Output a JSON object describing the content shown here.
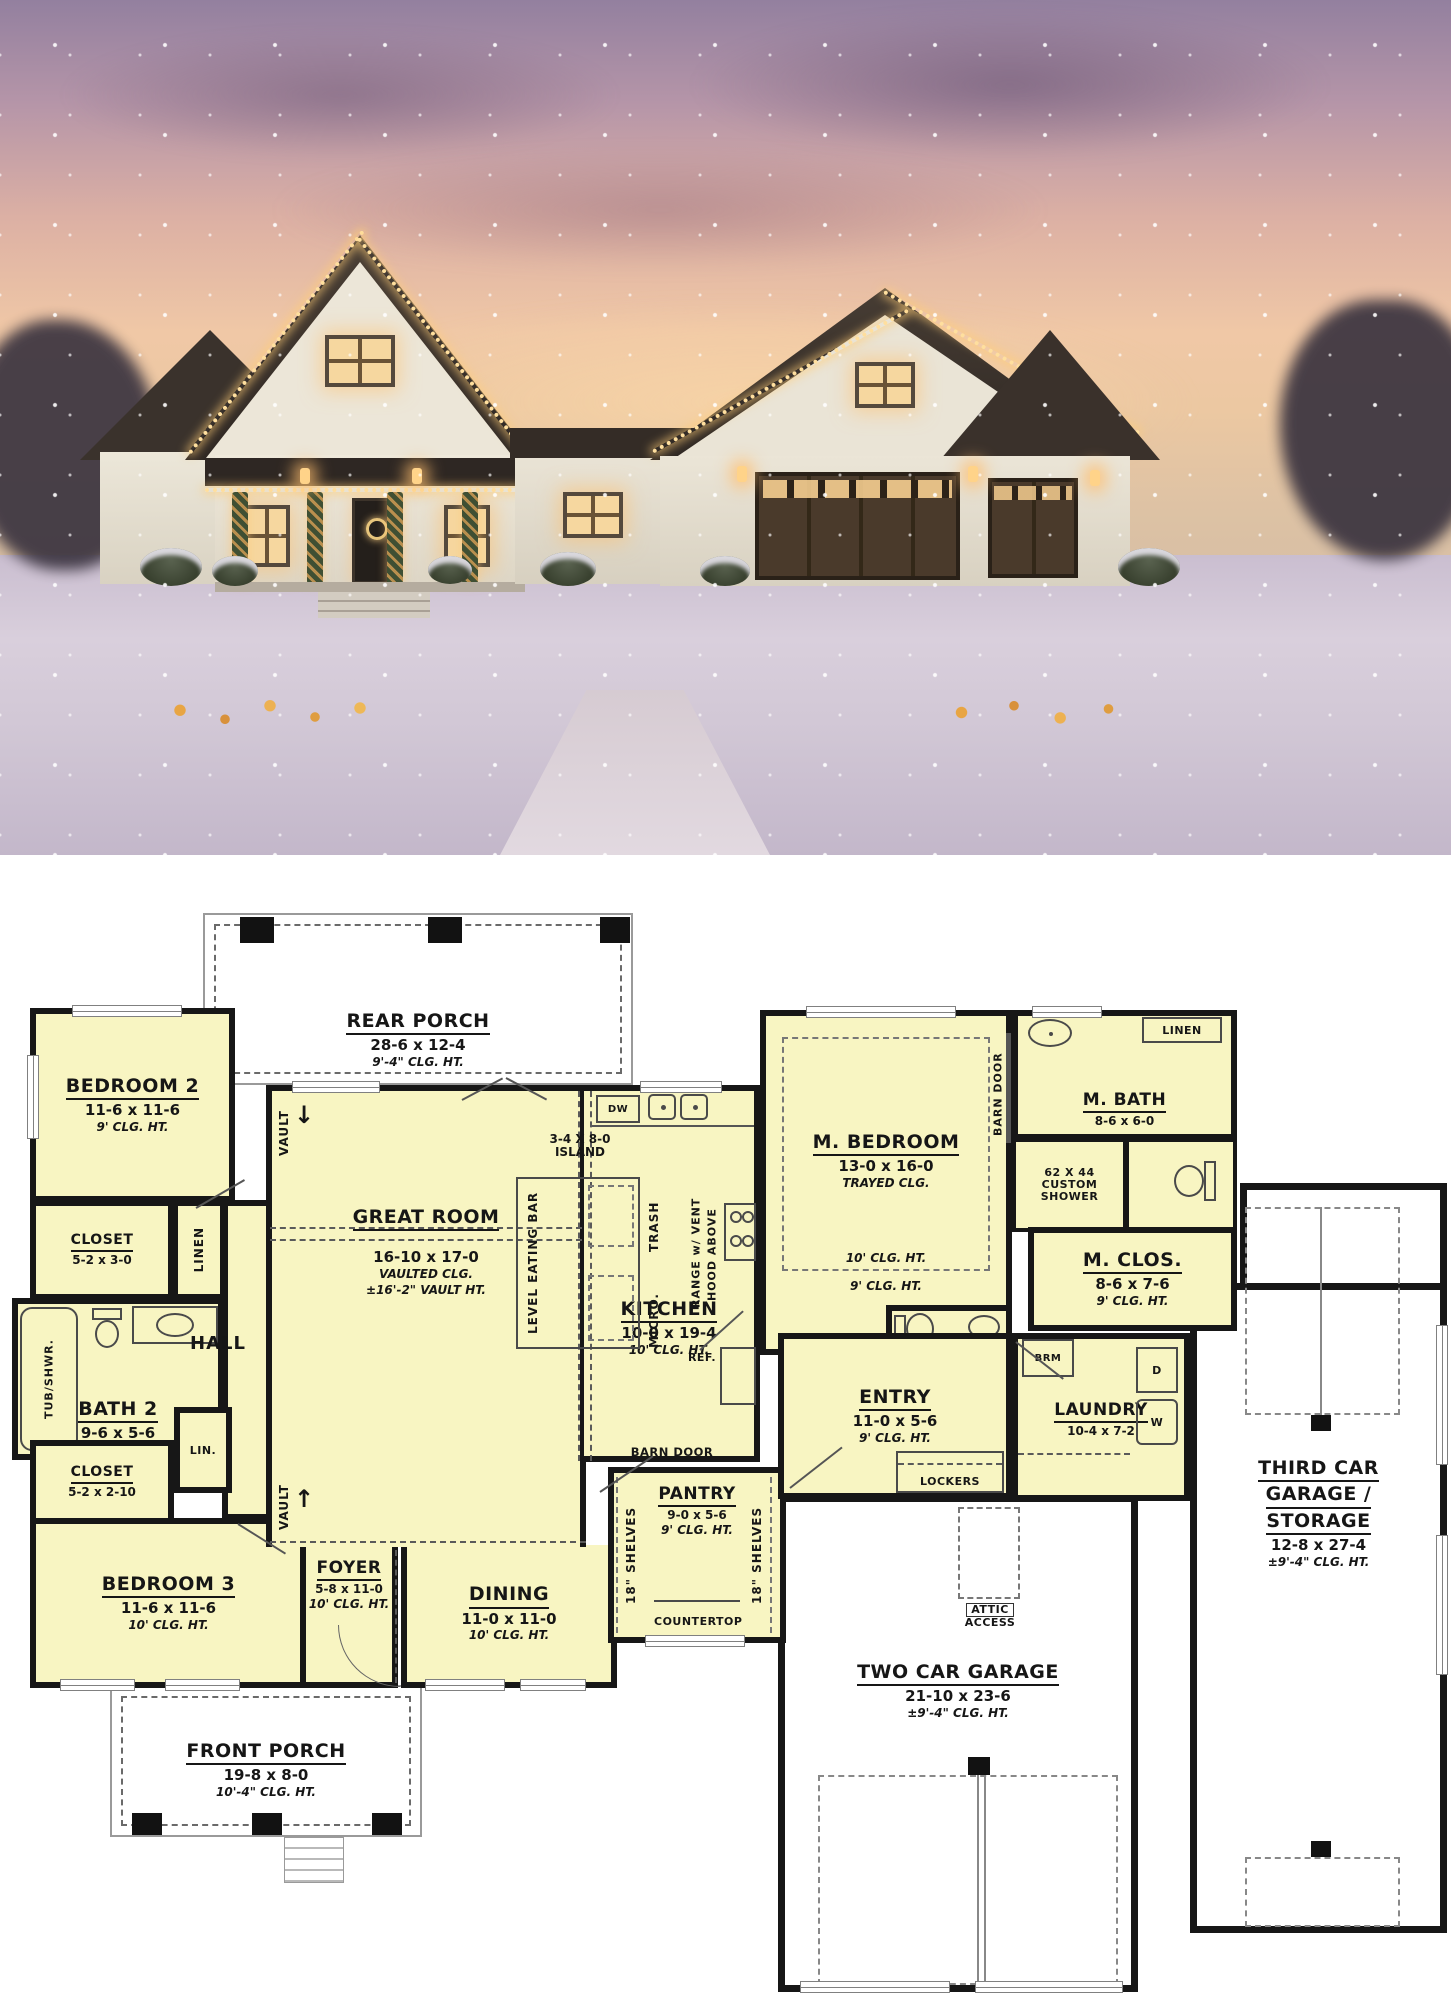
{
  "photo": {
    "colors": {
      "sky_top": "#9b87a9",
      "sky_horizon": "#f2cba6",
      "snow": "#d8cdd9",
      "roof": "#38302b",
      "wall": "#ece7da",
      "garage_door": "#4a392c",
      "warm_light": "#ffd99e"
    }
  },
  "plan": {
    "colors": {
      "room_fill": "#f8f5c2",
      "wall": "#171717",
      "porch_fill": "#ffffff"
    },
    "rooms": {
      "rear_porch": {
        "name": "REAR PORCH",
        "dims": "28-6 x 12-4",
        "clg": "9'-4\" CLG. HT."
      },
      "bedroom2": {
        "name": "BEDROOM 2",
        "dims": "11-6 x 11-6",
        "clg": "9' CLG. HT."
      },
      "closet_bed2": {
        "name": "CLOSET",
        "dims": "5-2 x 3-0"
      },
      "bath2": {
        "name": "BATH 2",
        "dims": "9-6 x 5-6"
      },
      "hall": {
        "name": "HALL"
      },
      "closet_bed3": {
        "name": "CLOSET",
        "dims": "5-2 x 2-10"
      },
      "bedroom3": {
        "name": "BEDROOM 3",
        "dims": "11-6 x 11-6",
        "clg": "10' CLG. HT."
      },
      "foyer": {
        "name": "FOYER",
        "dims": "5-8 x 11-0",
        "clg": "10' CLG. HT."
      },
      "dining": {
        "name": "DINING",
        "dims": "11-0 x 11-0",
        "clg": "10' CLG. HT."
      },
      "great_room": {
        "name": "GREAT ROOM",
        "dims": "16-10 x 17-0",
        "clg": "VAULTED CLG.",
        "clg2": "±16'-2\" VAULT HT."
      },
      "kitchen": {
        "name": "KITCHEN",
        "dims": "10-0 x 19-4",
        "clg": "10' CLG. HT."
      },
      "pantry": {
        "name": "PANTRY",
        "dims": "9-0 x 5-6",
        "clg": "9' CLG. HT."
      },
      "m_bedroom": {
        "name": "M. BEDROOM",
        "dims": "13-0 x 16-0",
        "clg": "TRAYED CLG.",
        "tray_in": "10' CLG. HT.",
        "tray_out": "9' CLG. HT."
      },
      "m_bath": {
        "name": "M. BATH",
        "dims": "8-6 x 6-0"
      },
      "m_clos": {
        "name": "M. CLOS.",
        "dims": "8-6 x 7-6",
        "clg": "9' CLG. HT."
      },
      "pwdr": {
        "name": "PWDR",
        "dims": "8-2 x 2-10"
      },
      "entry": {
        "name": "ENTRY",
        "dims": "11-0 x 5-6",
        "clg": "9' CLG. HT."
      },
      "laundry": {
        "name": "LAUNDRY",
        "dims": "10-4 x 7-2"
      },
      "two_car_garage": {
        "name": "TWO CAR GARAGE",
        "dims": "21-10 x 23-6",
        "clg": "±9'-4\" CLG. HT."
      },
      "third_car_garage": {
        "name_l1": "THIRD CAR",
        "name_l2": "GARAGE /",
        "name_l3": "STORAGE",
        "dims": "12-8 x 27-4",
        "clg": "±9'-4\" CLG. HT."
      },
      "front_porch": {
        "name": "FRONT PORCH",
        "dims": "19-8 x 8-0",
        "clg": "10'-4\" CLG. HT."
      }
    },
    "annotations": {
      "dw": "DW",
      "island_dims": "3-4 X 8-0",
      "island": "ISLAND",
      "eating_bar": "LEVEL EATING BAR",
      "trash": "TRASH",
      "micro": "MICRO.",
      "range_l1": "RANGE w/ VENT",
      "range_l2": "HOOD ABOVE",
      "ref": "REF.",
      "barn_door": "BARN DOOR",
      "countertop": "COUNTERTOP",
      "shelves": "18\" SHELVES",
      "linen": "LINEN",
      "lin": "LIN.",
      "tub_shwr": "TUB/SHWR.",
      "shower_l1": "62 X 44",
      "shower_l2": "CUSTOM",
      "shower_l3": "SHOWER",
      "brm": "BRM",
      "dryer": "D",
      "washer": "W",
      "lockers": "LOCKERS",
      "attic_l1": "ATTIC",
      "attic_l2": "ACCESS",
      "vault": "VAULT"
    }
  }
}
